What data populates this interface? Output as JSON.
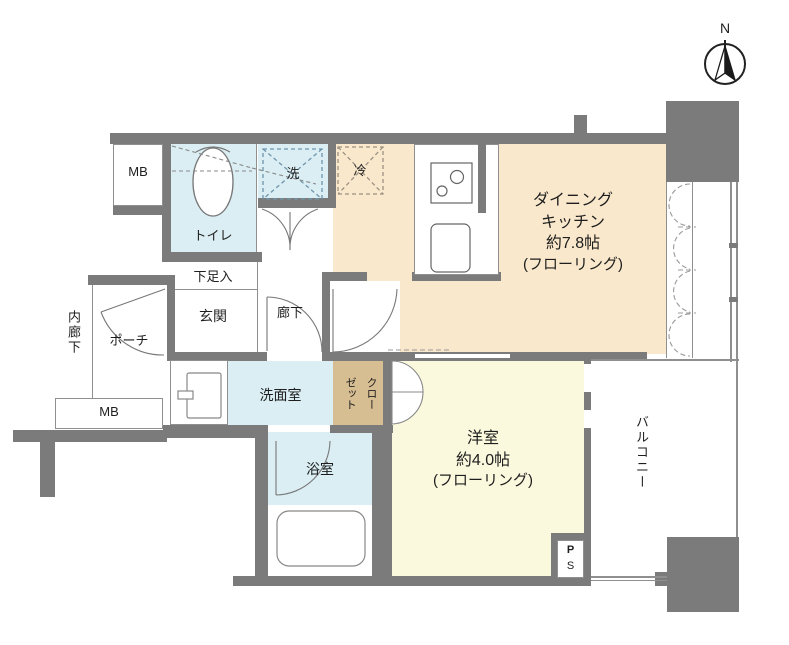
{
  "compass": {
    "north": "N"
  },
  "labels": {
    "mb_top": "MB",
    "toilet": "トイレ",
    "washer": "洗",
    "fridge": "冷",
    "shoe_cabinet": "下足入",
    "entrance": "玄関",
    "hallway": "廊下",
    "porch": "ポーチ",
    "inner_corridor": "内廊下",
    "mb_bottom": "MB",
    "washroom": "洗面室",
    "closet_col_right": "クロー",
    "closet_col_left": "ゼット",
    "bathroom": "浴室",
    "ps_top": "P",
    "ps_bottom": "S",
    "balcony": "バルコニー"
  },
  "dining_kitchen": {
    "line1": "ダイニング",
    "line2": "キッチン",
    "line3": "約7.8帖",
    "line4": "(フローリング)"
  },
  "western_room": {
    "line1": "洋室",
    "line2": "約4.0帖",
    "line3": "(フローリング)"
  },
  "colors": {
    "wall": "#7b7b7b",
    "dining_fill": "#f9e8cb",
    "western_room_fill": "#fbf9dd",
    "wet_area_fill": "#daeef3",
    "closet_fill": "#d6bd92"
  }
}
